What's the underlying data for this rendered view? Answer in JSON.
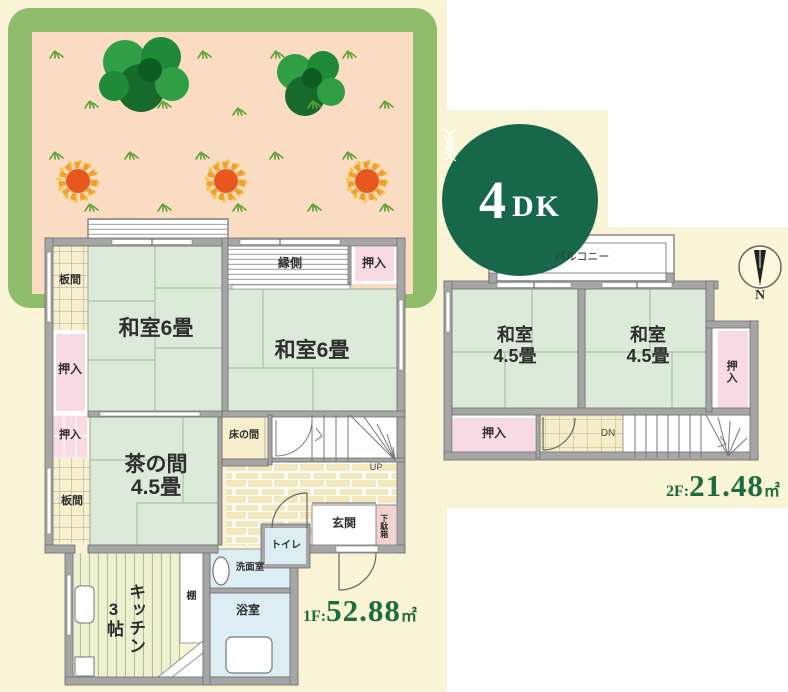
{
  "badge": {
    "number": "4",
    "suffix": "DK"
  },
  "compass": {
    "north_label": "N"
  },
  "floor1": {
    "rooms": {
      "itanoma_top": "板間",
      "oshiire_left": "押入",
      "oshiire_left_small": "押入",
      "itanoma_bottom": "板間",
      "washitsu_left": "和室6畳",
      "washitsu_right": "和室6畳",
      "engawa": "縁側",
      "oshiire_top_right": "押入",
      "chanoma_line1": "茶の間",
      "chanoma_line2": "4.5畳",
      "tokonoma": "床の間",
      "stairs_up": "UP",
      "genkan": "玄関",
      "getabako": "下駄箱",
      "toilet": "トイレ",
      "washroom": "洗面室",
      "bathroom": "浴室",
      "kitchen_line1": "キッチン",
      "kitchen_line2": "3帖",
      "shelf": "棚"
    },
    "area": {
      "prefix": "1F:",
      "value": "52.88",
      "unit": "㎡"
    }
  },
  "floor2": {
    "rooms": {
      "balcony": "バルコニー",
      "washitsu_left_line1": "和室",
      "washitsu_left_line2": "4.5畳",
      "washitsu_right_line1": "和室",
      "washitsu_right_line2": "4.5畳",
      "oshiire_bottom": "押入",
      "oshiire_right": "押入",
      "stairs_dn": "DN"
    },
    "area": {
      "prefix": "2F:",
      "value": "21.48",
      "unit": "㎡"
    }
  },
  "colors": {
    "page_yellow": "#f8f4d5",
    "accent_green": "#1d6b40",
    "badge_green": "#17684a",
    "hedge_green": "#8fbd69",
    "garden_pink": "#fadcc2",
    "sun_orange": "#e8571d",
    "tatami_green": "#dcead9",
    "closet_pink": "#f8dae4",
    "wet_area_blue": "#dcedf4",
    "wood_cream": "#f8efcd",
    "wall_gray": "#a6a6a6",
    "shoe_cabinet_pink": "#f2d3cf"
  }
}
